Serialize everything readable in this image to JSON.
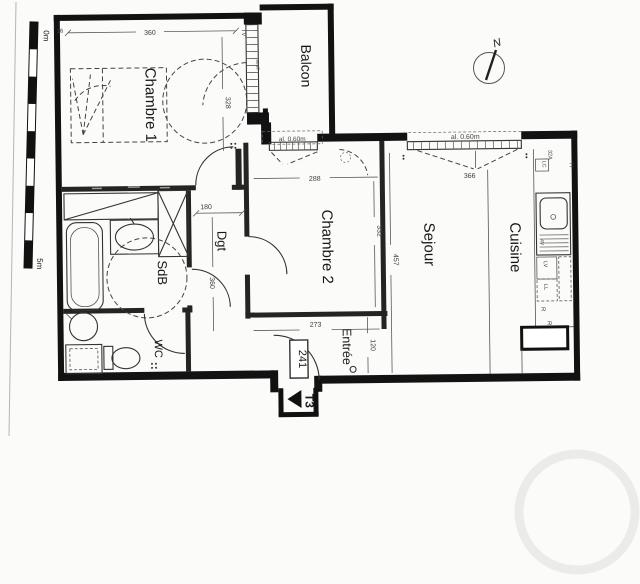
{
  "plan": {
    "rooms": {
      "chambre1": "Chambre 1",
      "chambre2": "Chambre 2",
      "sejour": "Sejour",
      "cuisine": "Cuisine",
      "balcon": "Balcon",
      "sdb": "SdB",
      "wc": "WC",
      "dgt": "Dgt",
      "entree": "Entrée"
    },
    "markers": {
      "north": "N",
      "apartment_type": "T3",
      "door_number": "241"
    },
    "scale_bar": {
      "start": "0m",
      "end": "5m"
    },
    "windows": {
      "sejour_sill": "al. 0.60m",
      "chambre2_sill": "al. 0.60m",
      "threshold": "seuil",
      "tv": "TV"
    },
    "kitchen_labels": {
      "amps": "32A",
      "lc": "LC",
      "hood": "H",
      "sink": "4V",
      "dishwasher": "LV",
      "washer": "LL",
      "fridge1": "R",
      "fridge2": "R"
    },
    "dimensions": {
      "d16": "16",
      "d360": "360",
      "d328": "328",
      "d288": "288",
      "d366": "366",
      "d332": "332",
      "d457": "457",
      "d180": "180",
      "d360b": "360",
      "d273": "273",
      "d120": "120"
    }
  }
}
